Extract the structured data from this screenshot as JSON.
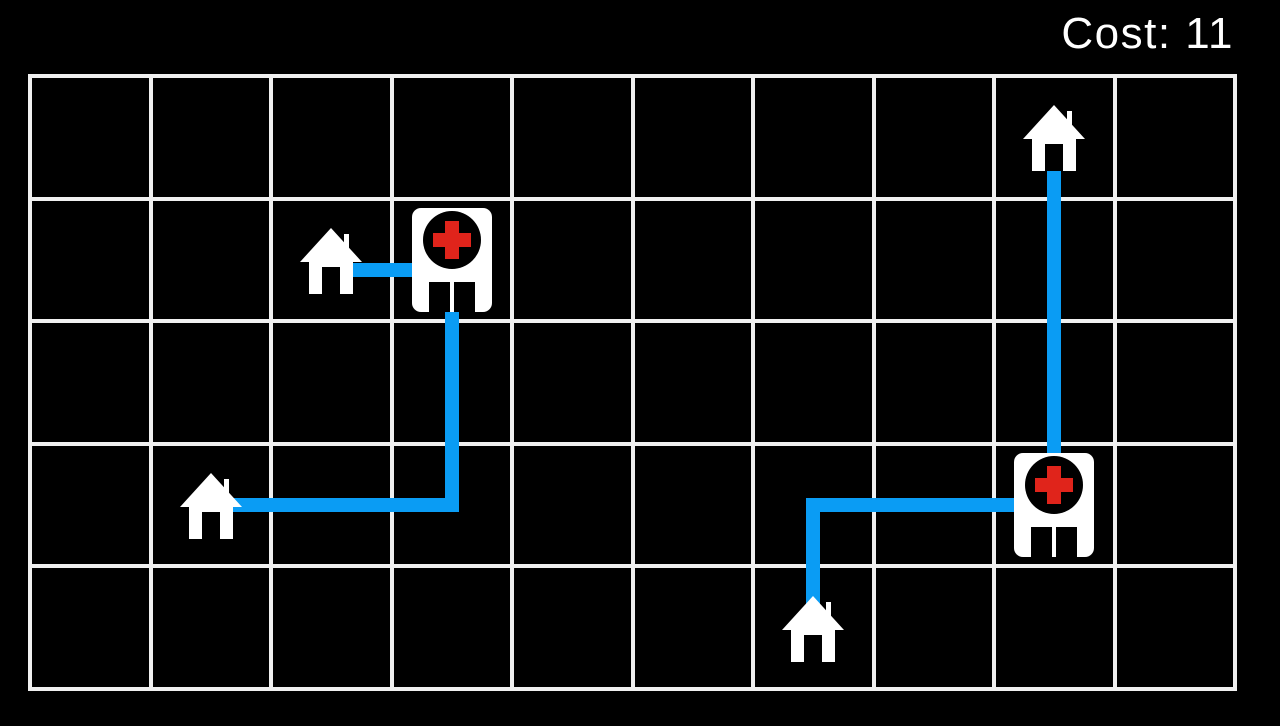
{
  "hud": {
    "cost_label": "Cost: 11",
    "cost_value": 11
  },
  "colors": {
    "background": "#000000",
    "grid_line": "#f0f0f0",
    "path_blue": "#0a9cf4",
    "cross_red": "#e0241b",
    "icon_white": "#ffffff",
    "text_white": "#ffffff"
  },
  "grid": {
    "cols": 10,
    "rows": 5
  },
  "entities": [
    {
      "type": "house",
      "id": "house-1",
      "col": 2,
      "row": 1
    },
    {
      "type": "hospital",
      "id": "hospital-1",
      "col": 3,
      "row": 1
    },
    {
      "type": "house",
      "id": "house-2",
      "col": 1,
      "row": 3
    },
    {
      "type": "house",
      "id": "house-3",
      "col": 6,
      "row": 4
    },
    {
      "type": "house",
      "id": "house-4",
      "col": 8,
      "row": 0
    },
    {
      "type": "hospital",
      "id": "hospital-2",
      "col": 8,
      "row": 3
    }
  ],
  "paths": [
    {
      "id": "path-house1-to-hospital1",
      "points": [
        [
          2,
          1
        ],
        [
          3,
          1
        ]
      ],
      "offset_y": 10
    },
    {
      "id": "path-hospital1-to-house2",
      "points": [
        [
          3,
          1
        ],
        [
          3,
          3
        ],
        [
          1,
          3
        ]
      ],
      "offset_y": 0
    },
    {
      "id": "path-house3-to-hospital2",
      "points": [
        [
          6,
          4
        ],
        [
          6,
          3
        ],
        [
          8,
          3
        ]
      ],
      "offset_y": 0
    },
    {
      "id": "path-house4-to-hospital2",
      "points": [
        [
          8,
          0
        ],
        [
          8,
          3
        ]
      ],
      "offset_y": 0
    }
  ]
}
